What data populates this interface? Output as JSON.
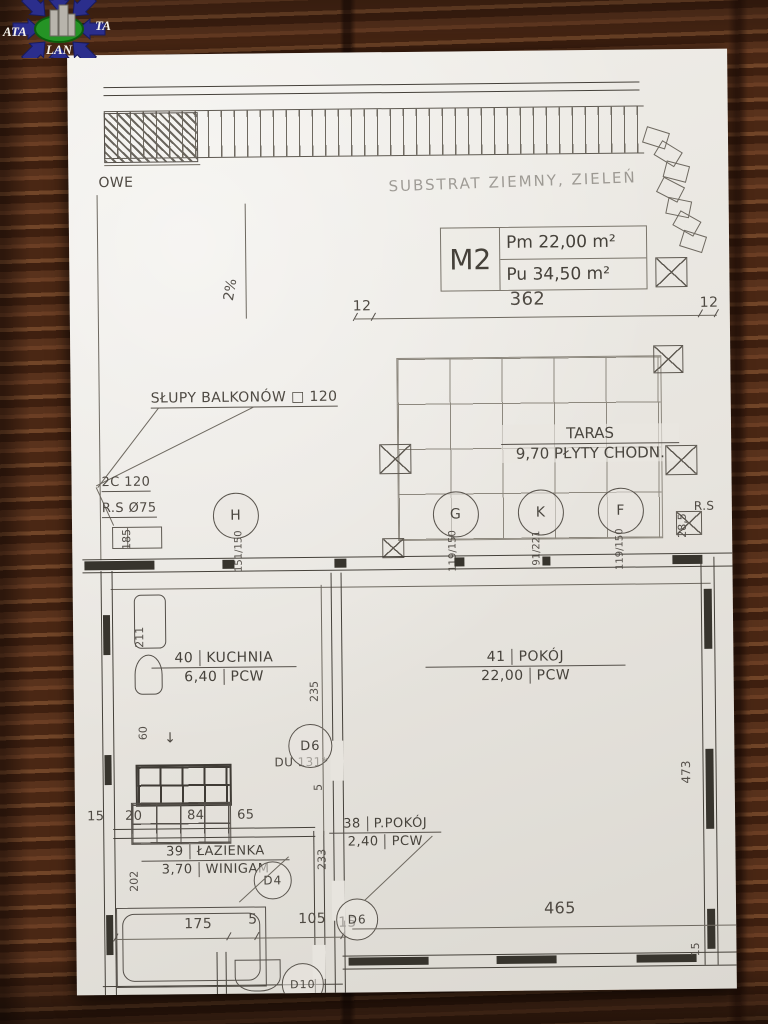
{
  "logo": {
    "left": "ATA",
    "right": "TA",
    "bottom": "LAN"
  },
  "annotations": {
    "edge_word": "OWE",
    "substrate": "SUBSTRAT ZIEMNY, ZIELEŃ",
    "slope": "2%",
    "columns_note": "SŁUPY BALKONÓW □ 120",
    "profile_note": "2C 120",
    "pipe_note": "R.S Ø75",
    "pipe_short": "R.S",
    "door_note": "DU 131*",
    "arrow_down": "↓"
  },
  "unit_box": {
    "unit": "M2",
    "area_pm": "Pm 22,00 m²",
    "area_pu": "Pu 34,50 m²"
  },
  "terrace": {
    "name": "TARAS",
    "detail": "9,70 PŁYTY CHODN."
  },
  "rooms": {
    "kitchen": {
      "no": "40",
      "name": "KUCHNIA",
      "area": "6,40",
      "floor": "PCW"
    },
    "living": {
      "no": "41",
      "name": "POKÓJ",
      "area": "22,00",
      "floor": "PCW"
    },
    "hall": {
      "no": "38",
      "name": "P.POKÓJ",
      "area": "2,40",
      "floor": "PCW"
    },
    "bath": {
      "no": "39",
      "name": "ŁAZIENKA",
      "area": "3,70",
      "floor": "WINIGAM"
    }
  },
  "markers": {
    "h": "H",
    "g": "G",
    "k": "K",
    "f": "F",
    "d6_upper": "D6",
    "d4": "D4",
    "d6_lower": "D6",
    "d10": "D10"
  },
  "dims": {
    "top_left": "12",
    "top_main": "362",
    "top_right": "12",
    "left_185": "185",
    "pair_h": "151/150",
    "pair_g": "119/150",
    "pair_k": "91/221",
    "pair_f": "119/150",
    "right_285": "28,5",
    "v211": "211",
    "v60": "60",
    "v235": "235",
    "v5": "5",
    "v233": "233",
    "v202": "202",
    "v473": "473",
    "v15_right": "15",
    "row15": "15",
    "row20": "20",
    "row84": "84",
    "row65": "65",
    "b175": "175",
    "b5": "5",
    "b105": "105",
    "b15": "15",
    "b465": "465"
  },
  "colors": {
    "paper": "#e9e6e0",
    "ink": "#55504a",
    "wood": "#4a2a18",
    "logo_blue": "#2b2e8c",
    "logo_green": "#259325"
  }
}
